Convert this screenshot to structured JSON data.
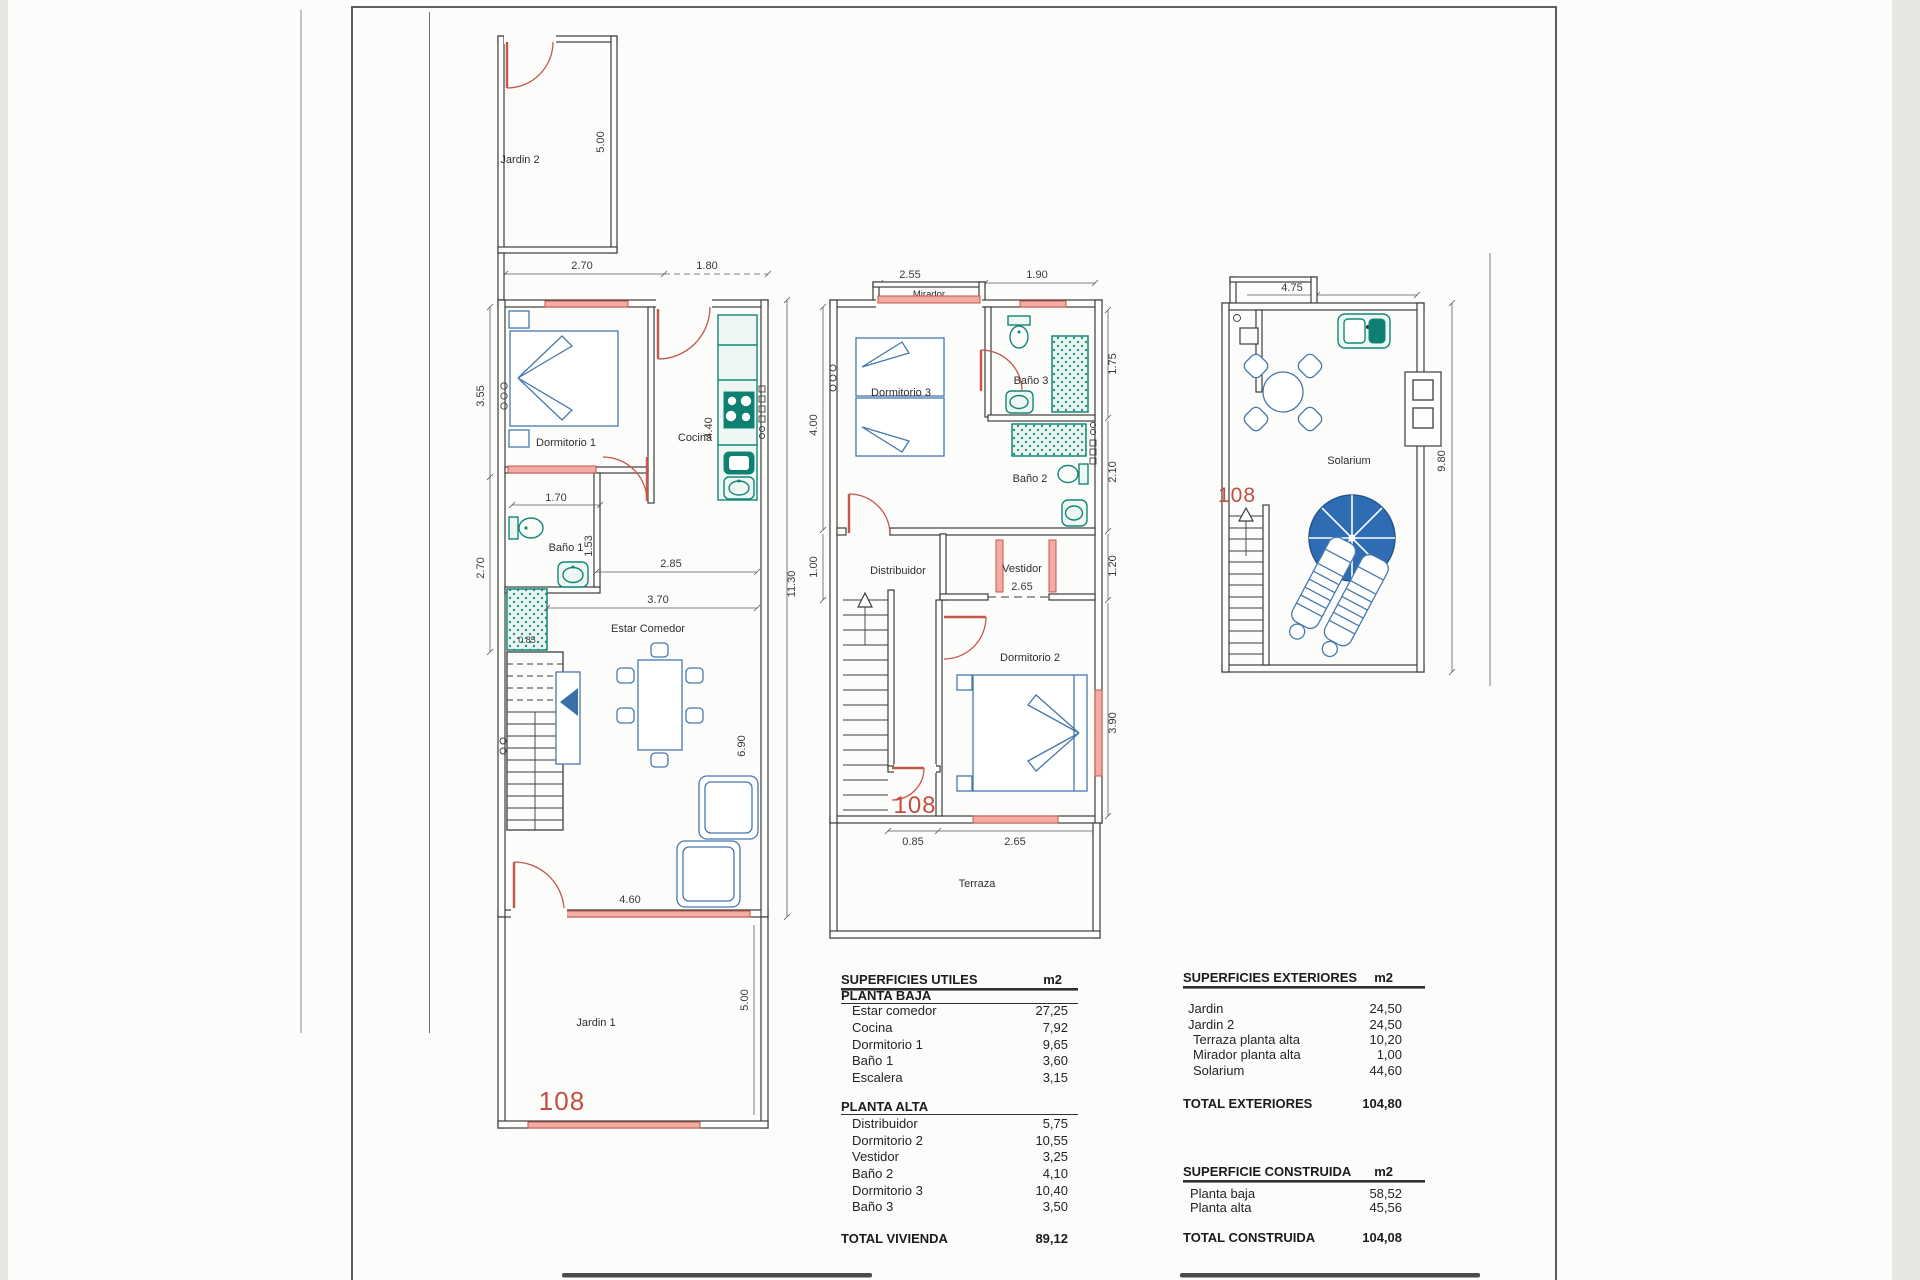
{
  "colors": {
    "line": "#3d3d3d",
    "red": "#c4564a",
    "red_fill": "#f2aca3",
    "teal": "#128778",
    "teal_dark": "#0f7f72",
    "blue": "#4578ad",
    "umbrella": "#2e6cb4",
    "text": "#2b2b2b"
  },
  "plans": {
    "planta_baja": {
      "unit_number": "108",
      "rooms": {
        "jardin2": "Jardin 2",
        "dormitorio1": "Dormitorio 1",
        "cocina": "Cocina",
        "bano1": "Baño 1",
        "estar": "Estar Comedor",
        "jardin1": "Jardin 1"
      },
      "dims": {
        "top_left": "2.70",
        "top_right": "1.80",
        "jardin2_depth": "5.00",
        "dorm1_height": "3.55",
        "bano1_width": "1.70",
        "bano1_height": "1.53",
        "bano1_left": "2.70",
        "estar_width_a": "2.85",
        "estar_width_b": "3.70",
        "shower_width": "0.85",
        "cocina_depth": "4.40",
        "estar_depth": "6.90",
        "total_depth": "11.30",
        "rear_exit": "4.60",
        "jardin1_depth": "5.00"
      }
    },
    "planta_alta": {
      "unit_number": "108",
      "rooms": {
        "mirador": "Mirador",
        "dormitorio3": "Dormitorio 3",
        "bano3": "Baño 3",
        "bano2": "Baño 2",
        "distribuidor": "Distribuidor",
        "vestidor": "Vestidor",
        "dormitorio2": "Dormitorio 2",
        "terraza": "Terraza"
      },
      "dims": {
        "mirador_width": "2.55",
        "front_width": "1.90",
        "dorm3_depth": "4.00",
        "bano3_depth": "1.75",
        "bano2_depth": "2.10",
        "landing_depth": "1.00",
        "vestidor_depth": "1.20",
        "vestidor_width": "2.65",
        "dorm2_depth": "3.90",
        "terraza_door": "0.85",
        "terraza_window": "2.65"
      }
    },
    "solarium": {
      "unit_number": "108",
      "rooms": {
        "solarium": "Solarium"
      },
      "dims": {
        "top_width": "4.75",
        "side_depth": "9.80"
      }
    }
  },
  "tables": {
    "utiles": {
      "title": "SUPERFICIES UTILES",
      "unit_header": "m2",
      "sections": [
        {
          "name": "PLANTA BAJA",
          "rows": [
            {
              "label": "Estar comedor",
              "value": "27,25"
            },
            {
              "label": "Cocina",
              "value": "7,92"
            },
            {
              "label": "Dormitorio 1",
              "value": "9,65"
            },
            {
              "label": "Baño 1",
              "value": "3,60"
            },
            {
              "label": "Escalera",
              "value": "3,15"
            }
          ]
        },
        {
          "name": "PLANTA ALTA",
          "rows": [
            {
              "label": "Distribuidor",
              "value": "5,75"
            },
            {
              "label": "Dormitorio 2",
              "value": "10,55"
            },
            {
              "label": "Vestidor",
              "value": "3,25"
            },
            {
              "label": "Baño 2",
              "value": "4,10"
            },
            {
              "label": "Dormitorio 3",
              "value": "10,40"
            },
            {
              "label": "Baño 3",
              "value": "3,50"
            }
          ]
        }
      ],
      "total": {
        "label": "TOTAL VIVIENDA",
        "value": "89,12"
      }
    },
    "exteriores": {
      "title": "SUPERFICIES EXTERIORES",
      "unit_header": "m2",
      "rows": [
        {
          "label": "Jardin",
          "value": "24,50"
        },
        {
          "label": "Jardin 2",
          "value": "24,50"
        },
        {
          "label": "Terraza planta alta",
          "value": "10,20"
        },
        {
          "label": "Mirador planta alta",
          "value": "1,00"
        },
        {
          "label": "Solarium",
          "value": "44,60"
        }
      ],
      "total": {
        "label": "TOTAL EXTERIORES",
        "value": "104,80"
      }
    },
    "construida": {
      "title": "SUPERFICIE CONSTRUIDA",
      "unit_header": "m2",
      "rows": [
        {
          "label": "Planta baja",
          "value": "58,52"
        },
        {
          "label": "Planta alta",
          "value": "45,56"
        }
      ],
      "total": {
        "label": "TOTAL CONSTRUIDA",
        "value": "104,08"
      }
    }
  }
}
